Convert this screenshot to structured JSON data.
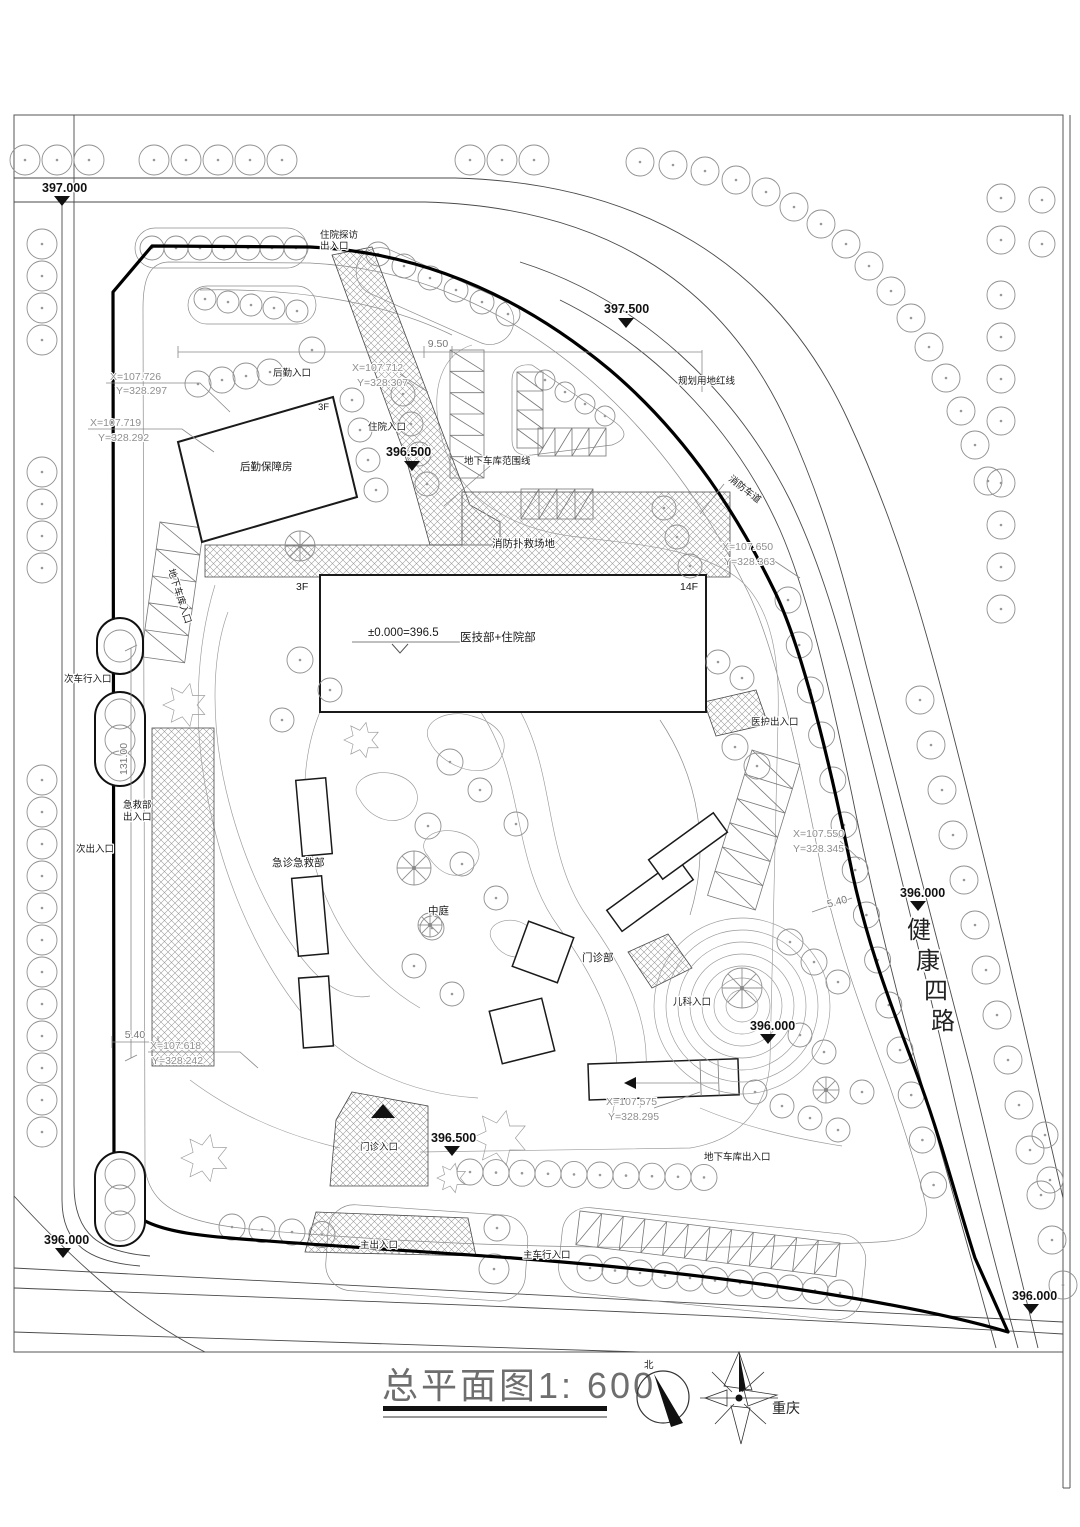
{
  "drawing": {
    "title": "总平面图1: 600",
    "city": "重庆",
    "north_label": "北",
    "road_name": "健康四路",
    "road_name_chars": [
      "健",
      "康",
      "四",
      "路"
    ]
  },
  "buildings": {
    "main_label": "医技部+住院部",
    "main_level_note": "±0.000=396.5",
    "main_floors_left": "3F",
    "main_floors_right": "14F",
    "logistics": "后勤保障房",
    "logistics_floors": "3F",
    "emergency": "急诊急救部",
    "outpatient": "门诊部",
    "atrium": "中庭"
  },
  "entrances": {
    "visit_line1": "住院探访",
    "visit_line2": "出入口",
    "logistics_entrance": "后勤入口",
    "inpatient_entrance": "住院入口",
    "secondary_vehicle": "次车行入口",
    "emergency_line1": "急救部",
    "emergency_line2": "出入口",
    "secondary_exit": "次出入口",
    "staff_exit": "医护出入口",
    "pediatric_entrance": "儿科入口",
    "outpatient_entrance": "门诊入口",
    "main_exit": "主出入口",
    "main_vehicle": "主车行入口",
    "garage_exit": "地下车库出入口",
    "garage_ramp": "地下车库入口"
  },
  "site": {
    "red_line_label": "规划用地红线",
    "fire_lane": "消防车道",
    "fire_site": "消防扑救场地",
    "garage_boundary": "地下车库范围线"
  },
  "elevations": {
    "e1": "397.000",
    "e2": "397.500",
    "e3": "396.500",
    "e4": "396.000",
    "e5": "396.000",
    "e6": "396.500",
    "e7": "396.000",
    "e8": "396.000"
  },
  "coordinates": {
    "p1x": "X=107.726",
    "p1y": "Y=328.297",
    "p2x": "X=107.719",
    "p2y": "Y=328.292",
    "p3x": "X=107.712",
    "p3y": "Y=328.307",
    "p4x": "X=107.650",
    "p4y": "Y=328.363",
    "p5x": "X=107.550",
    "p5y": "Y=328.345",
    "p6x": "X=107.618",
    "p6y": "Y=328.242",
    "p7x": "X=107.575",
    "p7y": "Y=328.295"
  },
  "dimensions": {
    "d1": "9.50",
    "d2": "131.00",
    "d3": "5.40",
    "d4": "5.40"
  }
}
